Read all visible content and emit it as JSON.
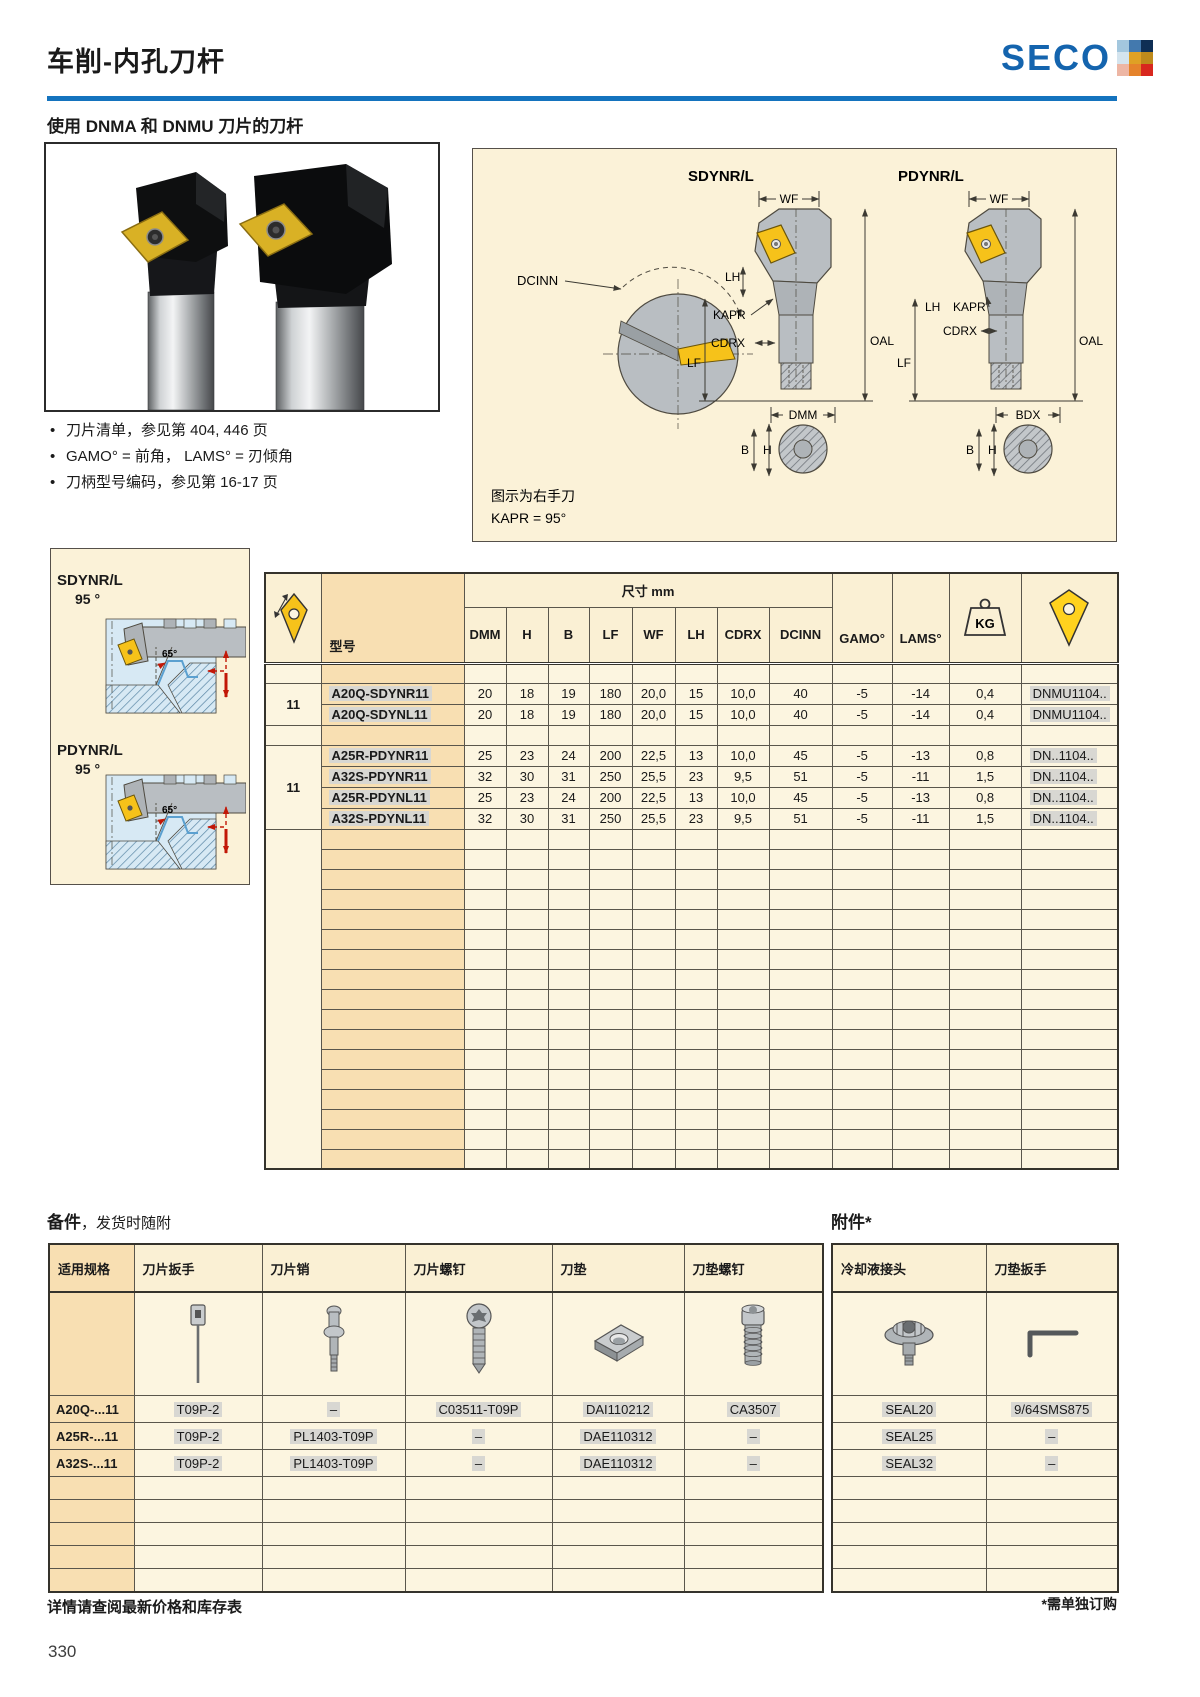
{
  "header": {
    "title": "车削-内孔刀杆",
    "brand": "SECO"
  },
  "brand_colors": [
    "#A3C7DE",
    "#4379AE",
    "#0F2F55",
    "#D4E4EE",
    "#DFA125",
    "#BE8A1B",
    "#EDB6A4",
    "#E5832B",
    "#D8271E"
  ],
  "intro": {
    "subtitle": "使用 DNMA 和 DNMU 刀片的刀杆",
    "bullets": [
      "刀片清单，参见第 404, 446 页",
      "GAMO° = 前角， LAMS° = 刃倾角",
      "刀柄型号编码，参见第 16-17 页"
    ]
  },
  "dim_panel": {
    "tool1": "SDYNR/L",
    "tool2": "PDYNR/L",
    "dcinn": "DCINN",
    "wf": "WF",
    "lh": "LH",
    "kapr": "KAPR",
    "cdrx": "CDRX",
    "lf": "LF",
    "oal": "OAL",
    "dmm": "DMM",
    "bdx": "BDX",
    "b": "B",
    "h": "H",
    "note1": "图示为右手刀",
    "note2": "KAPR = 95°"
  },
  "side_panel": {
    "items": [
      {
        "name": "SDYNR/L",
        "angle": "95 °",
        "tip_angle": "65°"
      },
      {
        "name": "PDYNR/L",
        "angle": "95 °",
        "tip_angle": "65°"
      }
    ]
  },
  "main_table": {
    "dim_header": "尺寸 mm",
    "model_header": "型号",
    "kg_label": "KG",
    "columns": [
      "DMM",
      "H",
      "B",
      "LF",
      "WF",
      "LH",
      "CDRX",
      "DCINN",
      "GAMO°",
      "LAMS°"
    ],
    "groups": [
      {
        "size": "11",
        "rows": [
          {
            "model": "A20Q-SDYNR11",
            "values": [
              "20",
              "18",
              "19",
              "180",
              "20,0",
              "15",
              "10,0",
              "40",
              "-5",
              "-14"
            ],
            "kg": "0,4",
            "insert": "DNMU1104.."
          },
          {
            "model": "A20Q-SDYNL11",
            "values": [
              "20",
              "18",
              "19",
              "180",
              "20,0",
              "15",
              "10,0",
              "40",
              "-5",
              "-14"
            ],
            "kg": "0,4",
            "insert": "DNMU1104.."
          }
        ]
      },
      {
        "size": "11",
        "rows": [
          {
            "model": "A25R-PDYNR11",
            "values": [
              "25",
              "23",
              "24",
              "200",
              "22,5",
              "13",
              "10,0",
              "45",
              "-5",
              "-13"
            ],
            "kg": "0,8",
            "insert": "DN..1104.."
          },
          {
            "model": "A32S-PDYNR11",
            "values": [
              "32",
              "30",
              "31",
              "250",
              "25,5",
              "23",
              "9,5",
              "51",
              "-5",
              "-11"
            ],
            "kg": "1,5",
            "insert": "DN..1104.."
          },
          {
            "model": "A25R-PDYNL11",
            "values": [
              "25",
              "23",
              "24",
              "200",
              "22,5",
              "13",
              "10,0",
              "45",
              "-5",
              "-13"
            ],
            "kg": "0,8",
            "insert": "DN..1104.."
          },
          {
            "model": "A32S-PDYNL11",
            "values": [
              "32",
              "30",
              "31",
              "250",
              "25,5",
              "23",
              "9,5",
              "51",
              "-5",
              "-11"
            ],
            "kg": "1,5",
            "insert": "DN..1104.."
          }
        ]
      }
    ],
    "empty_row_count": 17
  },
  "spares": {
    "title_bold": "备件",
    "title_rest": "，发货时随附",
    "accessories_title": "附件*",
    "left_columns": [
      "适用规格",
      "刀片扳手",
      "刀片销",
      "刀片螺钉",
      "刀垫",
      "刀垫螺钉"
    ],
    "right_columns": [
      "冷却液接头",
      "刀垫扳手"
    ],
    "rows": [
      {
        "model": "A20Q-...11",
        "values": [
          "T09P-2",
          "–",
          "C03511-T09P",
          "DAI110212",
          "CA3507"
        ],
        "right": [
          "SEAL20",
          "9/64SMS875"
        ]
      },
      {
        "model": "A25R-...11",
        "values": [
          "T09P-2",
          "PL1403-T09P",
          "–",
          "DAE110312",
          "–"
        ],
        "right": [
          "SEAL25",
          "–"
        ]
      },
      {
        "model": "A32S-...11",
        "values": [
          "T09P-2",
          "PL1403-T09P",
          "–",
          "DAE110312",
          "–"
        ],
        "right": [
          "SEAL32",
          "–"
        ]
      }
    ],
    "empty_row_count": 5
  },
  "footer": {
    "left": "详情请查阅最新价格和库存表",
    "right": "*需单独订购",
    "page_number": "330"
  }
}
